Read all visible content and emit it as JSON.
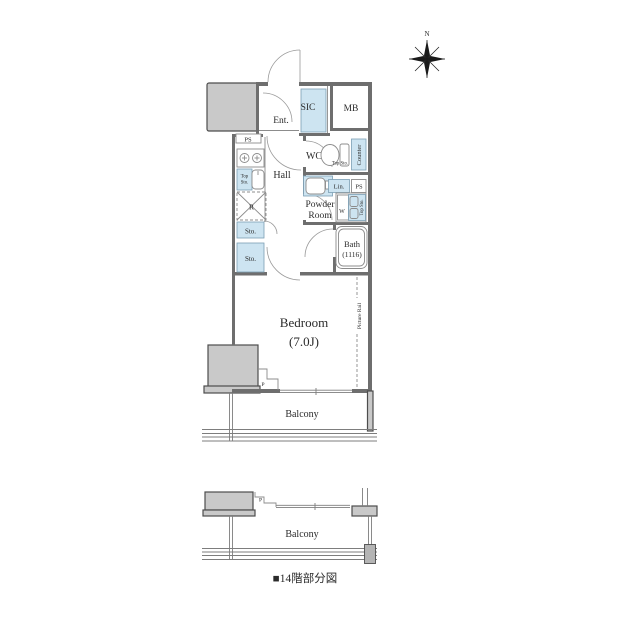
{
  "title": "apartment-floor-plan",
  "labels": {
    "north": "N",
    "ent": "Ent.",
    "sic": "SIC",
    "mb": "MB",
    "ps": "PS",
    "wc": "WC",
    "hall": "Hall",
    "counter": "Counter",
    "top": "Top",
    "sto": "Sto.",
    "top_sto": "Top Sto.",
    "lin": "Lin.",
    "powder_1": "Powder",
    "powder_2": "Room",
    "r": "R",
    "w": "W",
    "bath_1": "Bath",
    "bath_2": "(1116)",
    "bedroom_1": "Bedroom",
    "bedroom_2": "(7.0J)",
    "picture_rail": "Picture Rail",
    "balcony": "Balcony",
    "p": "P",
    "caption": "■14階部分図"
  },
  "colors": {
    "wall": "#6e6e6e",
    "block_fill": "#c9c9c9",
    "block_stroke": "#4d4d4d",
    "fixture_blue": "#cde4f1",
    "fixture_stroke": "#7c9fb5",
    "line": "#8c8c8c",
    "text": "#2b2b2b",
    "compass": "#1a1a1a"
  }
}
